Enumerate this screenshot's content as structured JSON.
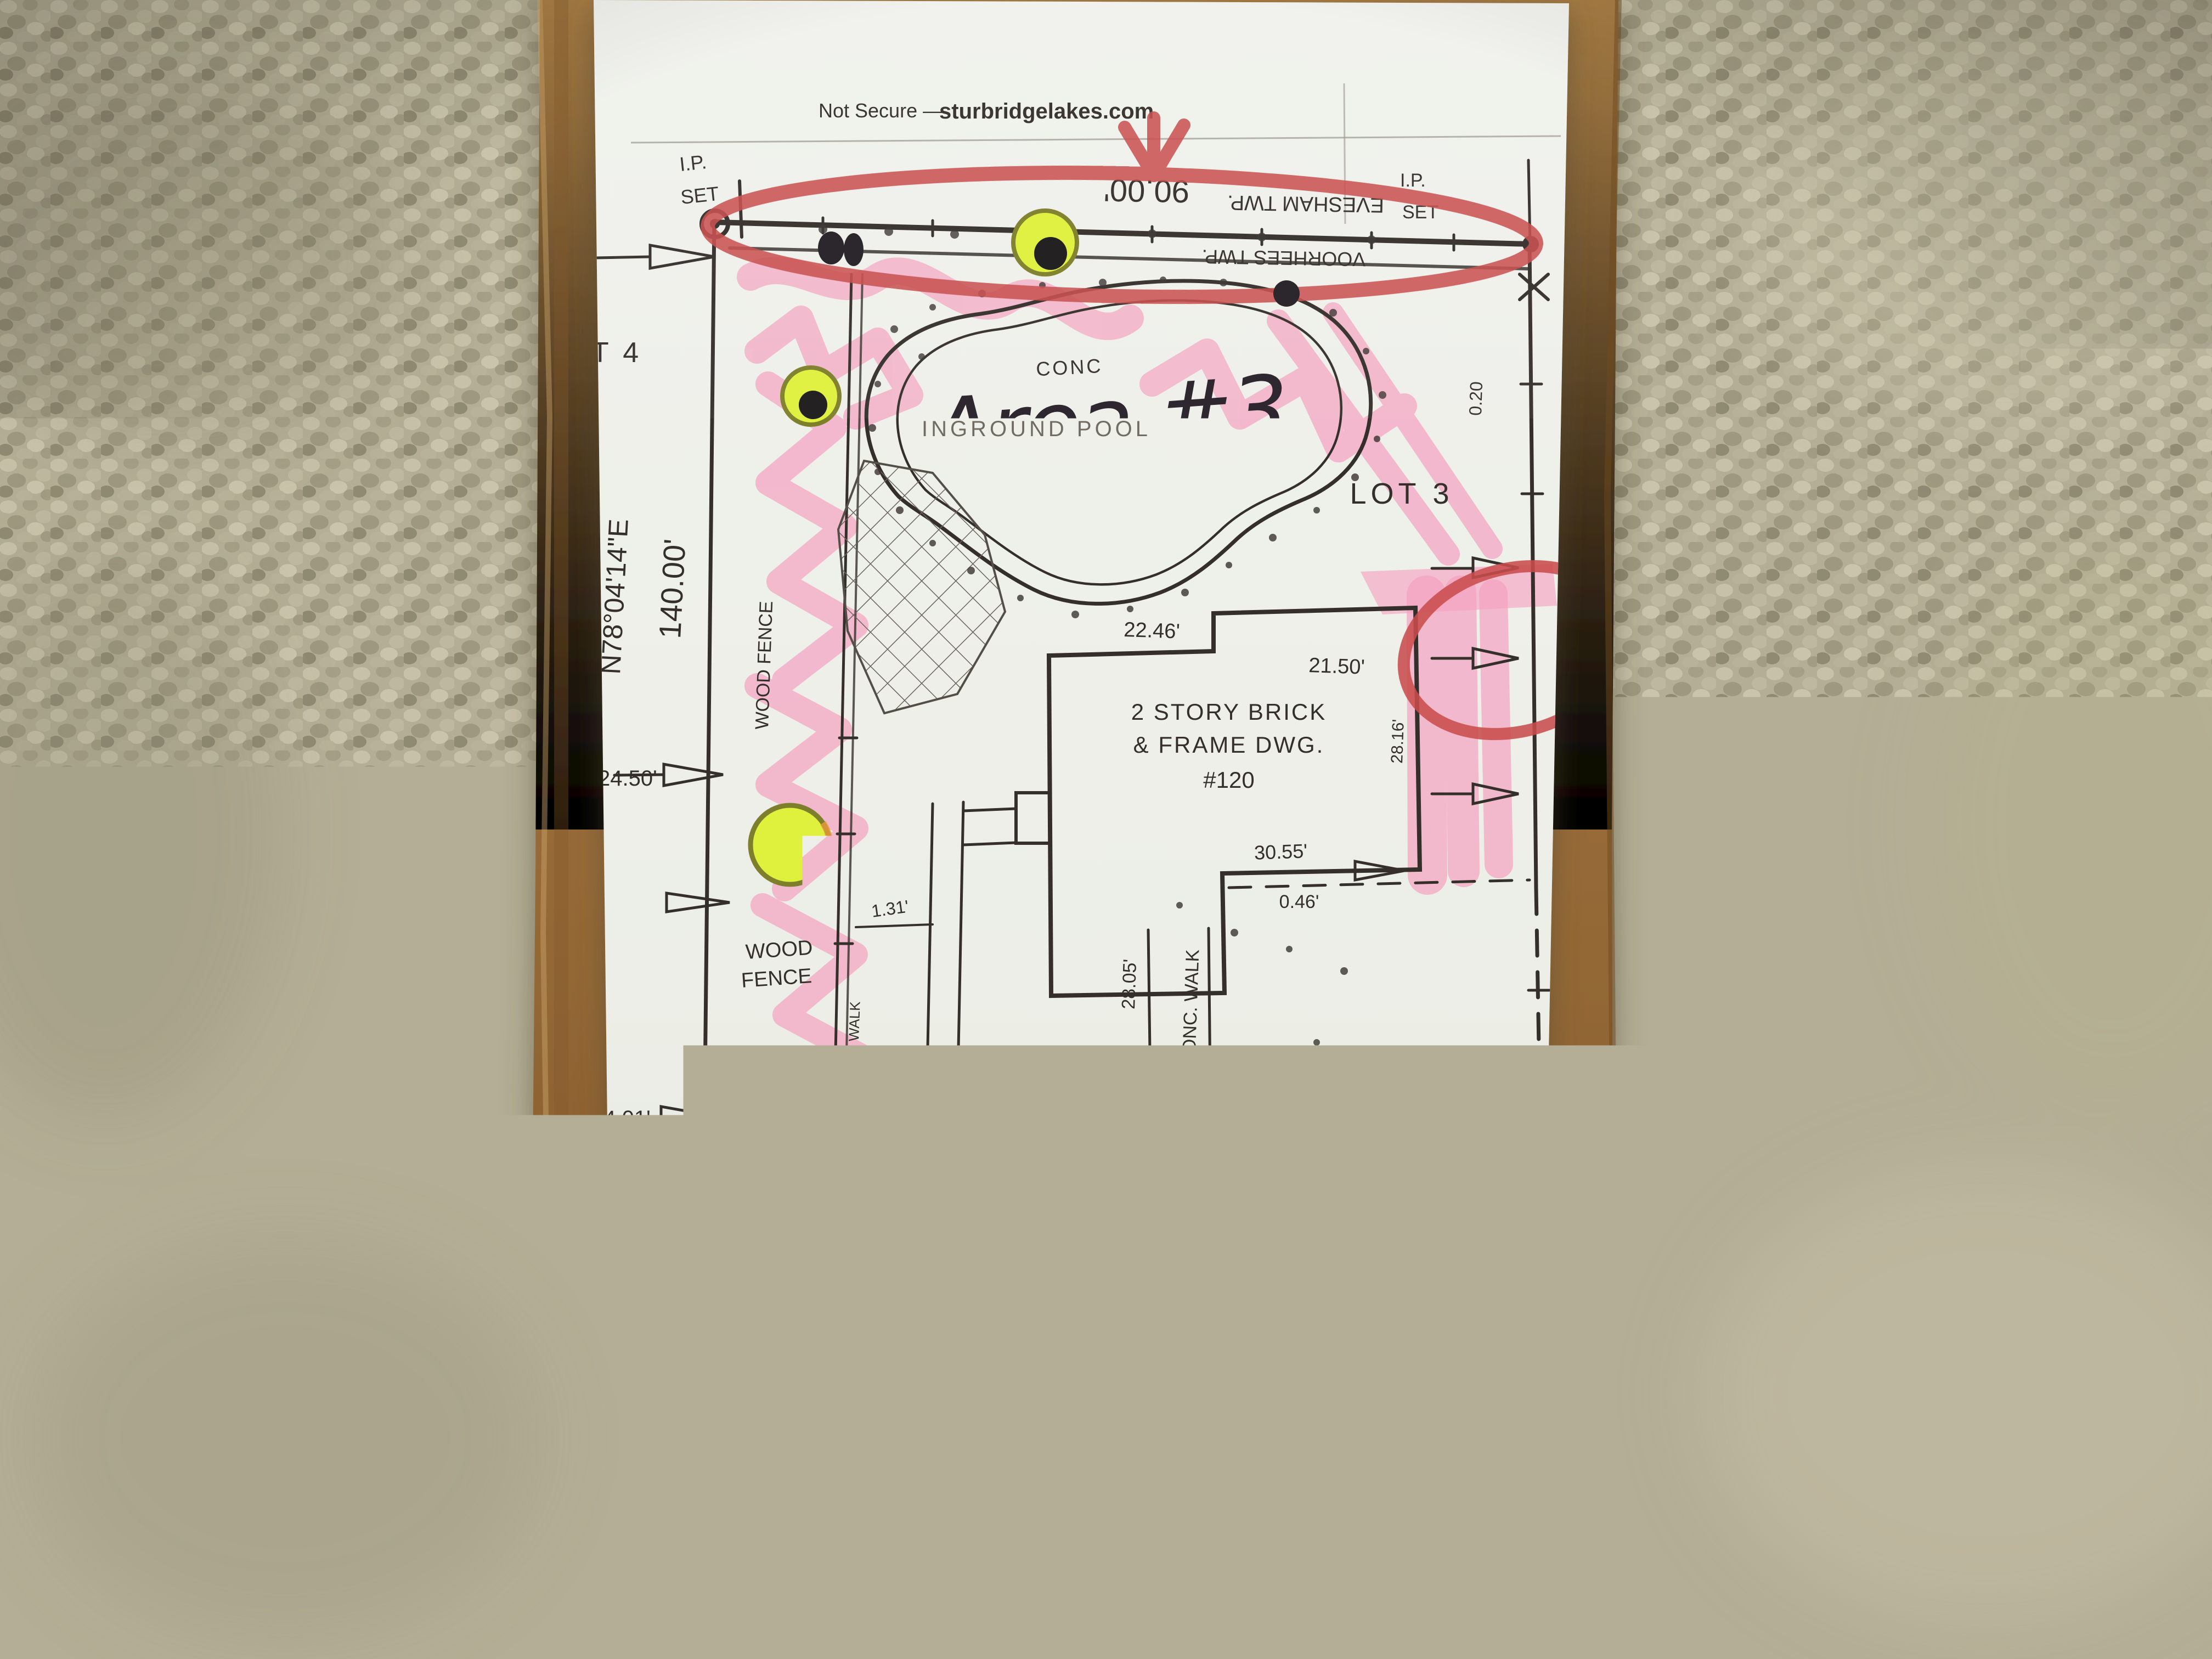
{
  "scene": {
    "carpet_color": "#b3ae95",
    "cardboard_color": "#9a7340",
    "paper_color": "#eef0ea",
    "highlighter_pink": "#f59fc0",
    "marker_red": "#c94d4d",
    "highlighter_yellow": "#dff13d",
    "pen_black": "#241f24"
  },
  "browser_bar": {
    "security_label": "Not Secure —",
    "domain": "sturbridgelakes.com"
  },
  "survey": {
    "lot_label_left": "T 4",
    "lot_label_right": "LOT 3",
    "ip_set_top_left": {
      "line1": "I.P.",
      "line2": "SET"
    },
    "ip_set_top_right": {
      "line1": "I.P.",
      "line2": "SET"
    },
    "boundary_top": {
      "length": "90.00'",
      "township_upper": "EVESHAM TWP.",
      "township_lower": "VOORHEES TWP."
    },
    "boundary_west": {
      "bearing": "N78°04'14\"E",
      "length": "140.00'"
    },
    "boundary_south": {
      "bearing": "N11°55'46\"W",
      "length": "90.00'"
    },
    "dimensions": {
      "d22_46": "22.46'",
      "d21_50": "21.50'",
      "d24_50": "24.50'",
      "d24_01": "24.01'",
      "d30_55": "30.55'",
      "d0_46": "0.46'",
      "d28_16": "28.16'",
      "d28_05": "28.05'",
      "d23_00": "23.00'",
      "d1_31": "1.31'",
      "d0_20": "0.20",
      "d59_13": "59.13'",
      "d58_84": "58.84'"
    },
    "features": {
      "pool_conc": "CONC",
      "pool": "INGROUND POOL",
      "house_line1": "2 STORY BRICK",
      "house_line2": "& FRAME DWG.",
      "house_line3": "#120",
      "wood_fence_vertical": "WOOD FENCE",
      "wood_fence_line1": "WOOD",
      "wood_fence_line2": "FENCE",
      "brick_walk": "BRICK WALK",
      "conc_walk": "CONC. WALK",
      "conc_driveway": "CONC. DRIVEWAY"
    }
  },
  "annotations": {
    "area1_line1": "Area",
    "area1_line2": "#1",
    "area2_line1": "Area",
    "area2_line2": "#2",
    "area3": "Area #3"
  }
}
